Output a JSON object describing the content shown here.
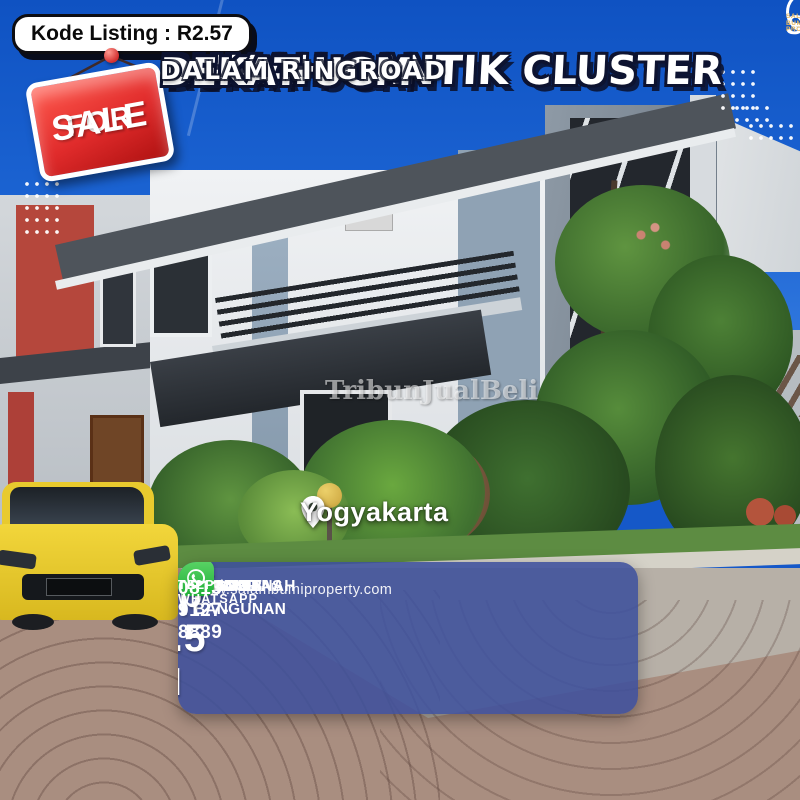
{
  "listing": {
    "code_label": "Kode Listing : R2.57",
    "sale_sign": {
      "line1": "FOR",
      "line2": "SALE"
    },
    "title_line1": "RUMAH CANTIK CLUSTER",
    "title_line2": "DEKAT UGM",
    "subtitle": "DALAM RINGROAD",
    "city": "Yogyakarta",
    "watermark": "TribunJualBeli"
  },
  "brand": {
    "abbr": "SBP",
    "tagline": "SALAM BUMI PROPERTY"
  },
  "specs": {
    "separator": ":",
    "rows": [
      {
        "label": "LUAS TANAH",
        "value": "130 M²"
      },
      {
        "label": "LUAS BANGUNAN",
        "value": "220 M²"
      },
      {
        "label": "K.TIDUR",
        "value": "4"
      },
      {
        "label": "K.MANDI",
        "value": "4"
      },
      {
        "label": "LEGALITAS",
        "value": "SHM IMB"
      }
    ],
    "website": "www.salambumiproperty.com"
  },
  "price": {
    "label": "PRICE",
    "value": "Rp 2.5 M",
    "contact_label": "TELP / WHATSAPP",
    "phone": "0813-9127-8889"
  },
  "colors": {
    "sky_blue": "#1558C8",
    "sign_red": "#E02B2B",
    "price_accent": "#F0A648",
    "panel_blue": "#3E509C",
    "whatsapp_green": "#2BB741",
    "tagline_gold": "#E8B860"
  }
}
